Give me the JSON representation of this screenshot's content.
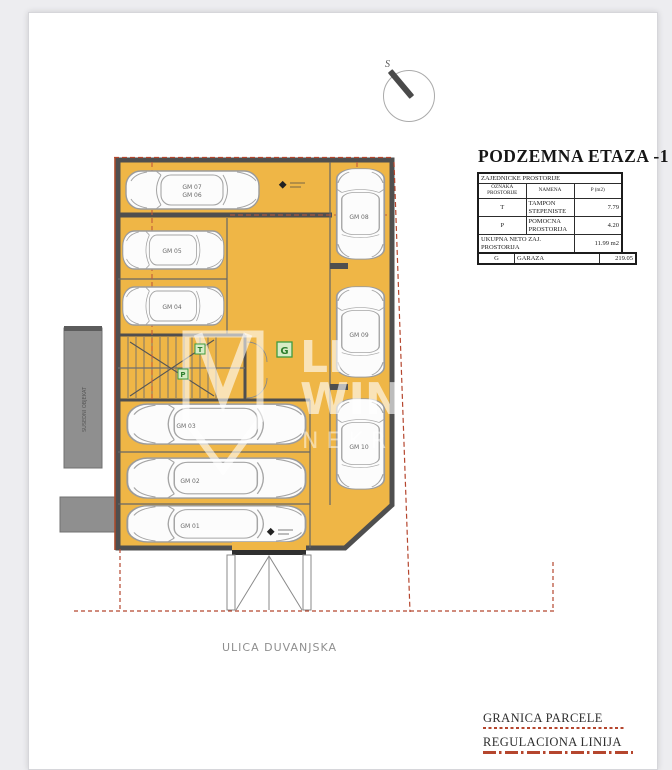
{
  "page": {
    "title": "PODZEMNA ETAZA -1",
    "street_label": "ULICA DUVANJSKA",
    "compass_label": "S",
    "neighbor_label": "SUSEDNI OBJEKAT"
  },
  "tables": {
    "common": {
      "header_span": "ZAJEDNICKE PROSTORIJE",
      "columns": [
        "OZNAKA PROSTORIJE",
        "NAMENA",
        "P (m2)"
      ],
      "rows": [
        [
          "T",
          "TAMPON STEPENISTE",
          "7.79"
        ],
        [
          "P",
          "POMOCNA PROSTORIJA",
          "4.20"
        ]
      ],
      "footer_label": "UKUPNA NETO ZAJ. PROSTORIJA",
      "footer_value": "11.99 m2"
    },
    "garage": {
      "rows": [
        [
          "G",
          "GARAZA",
          "219.05"
        ]
      ]
    }
  },
  "legend": {
    "items": [
      {
        "label": "GRANICA PARCELE",
        "style": "dotted"
      },
      {
        "label": "REGULACIONA LINIJA",
        "style": "dashdot"
      }
    ]
  },
  "plan": {
    "cars": [
      "GM 07",
      "GM 06",
      "GM 05",
      "GM 04",
      "GM 03",
      "GM 02",
      "GM 01",
      "GM 08",
      "GM 09",
      "GM 10"
    ],
    "room_tags": {
      "garage": "G",
      "stair": "T",
      "aux": "P"
    }
  },
  "watermark": {
    "line1": "LI",
    "line2": "WIN",
    "line3": "NEKR"
  },
  "colors": {
    "floor": "#efb646",
    "wall": "#4f4f4f",
    "boundary_red": "#b5462e",
    "tag_green": "#2f8f2f"
  }
}
